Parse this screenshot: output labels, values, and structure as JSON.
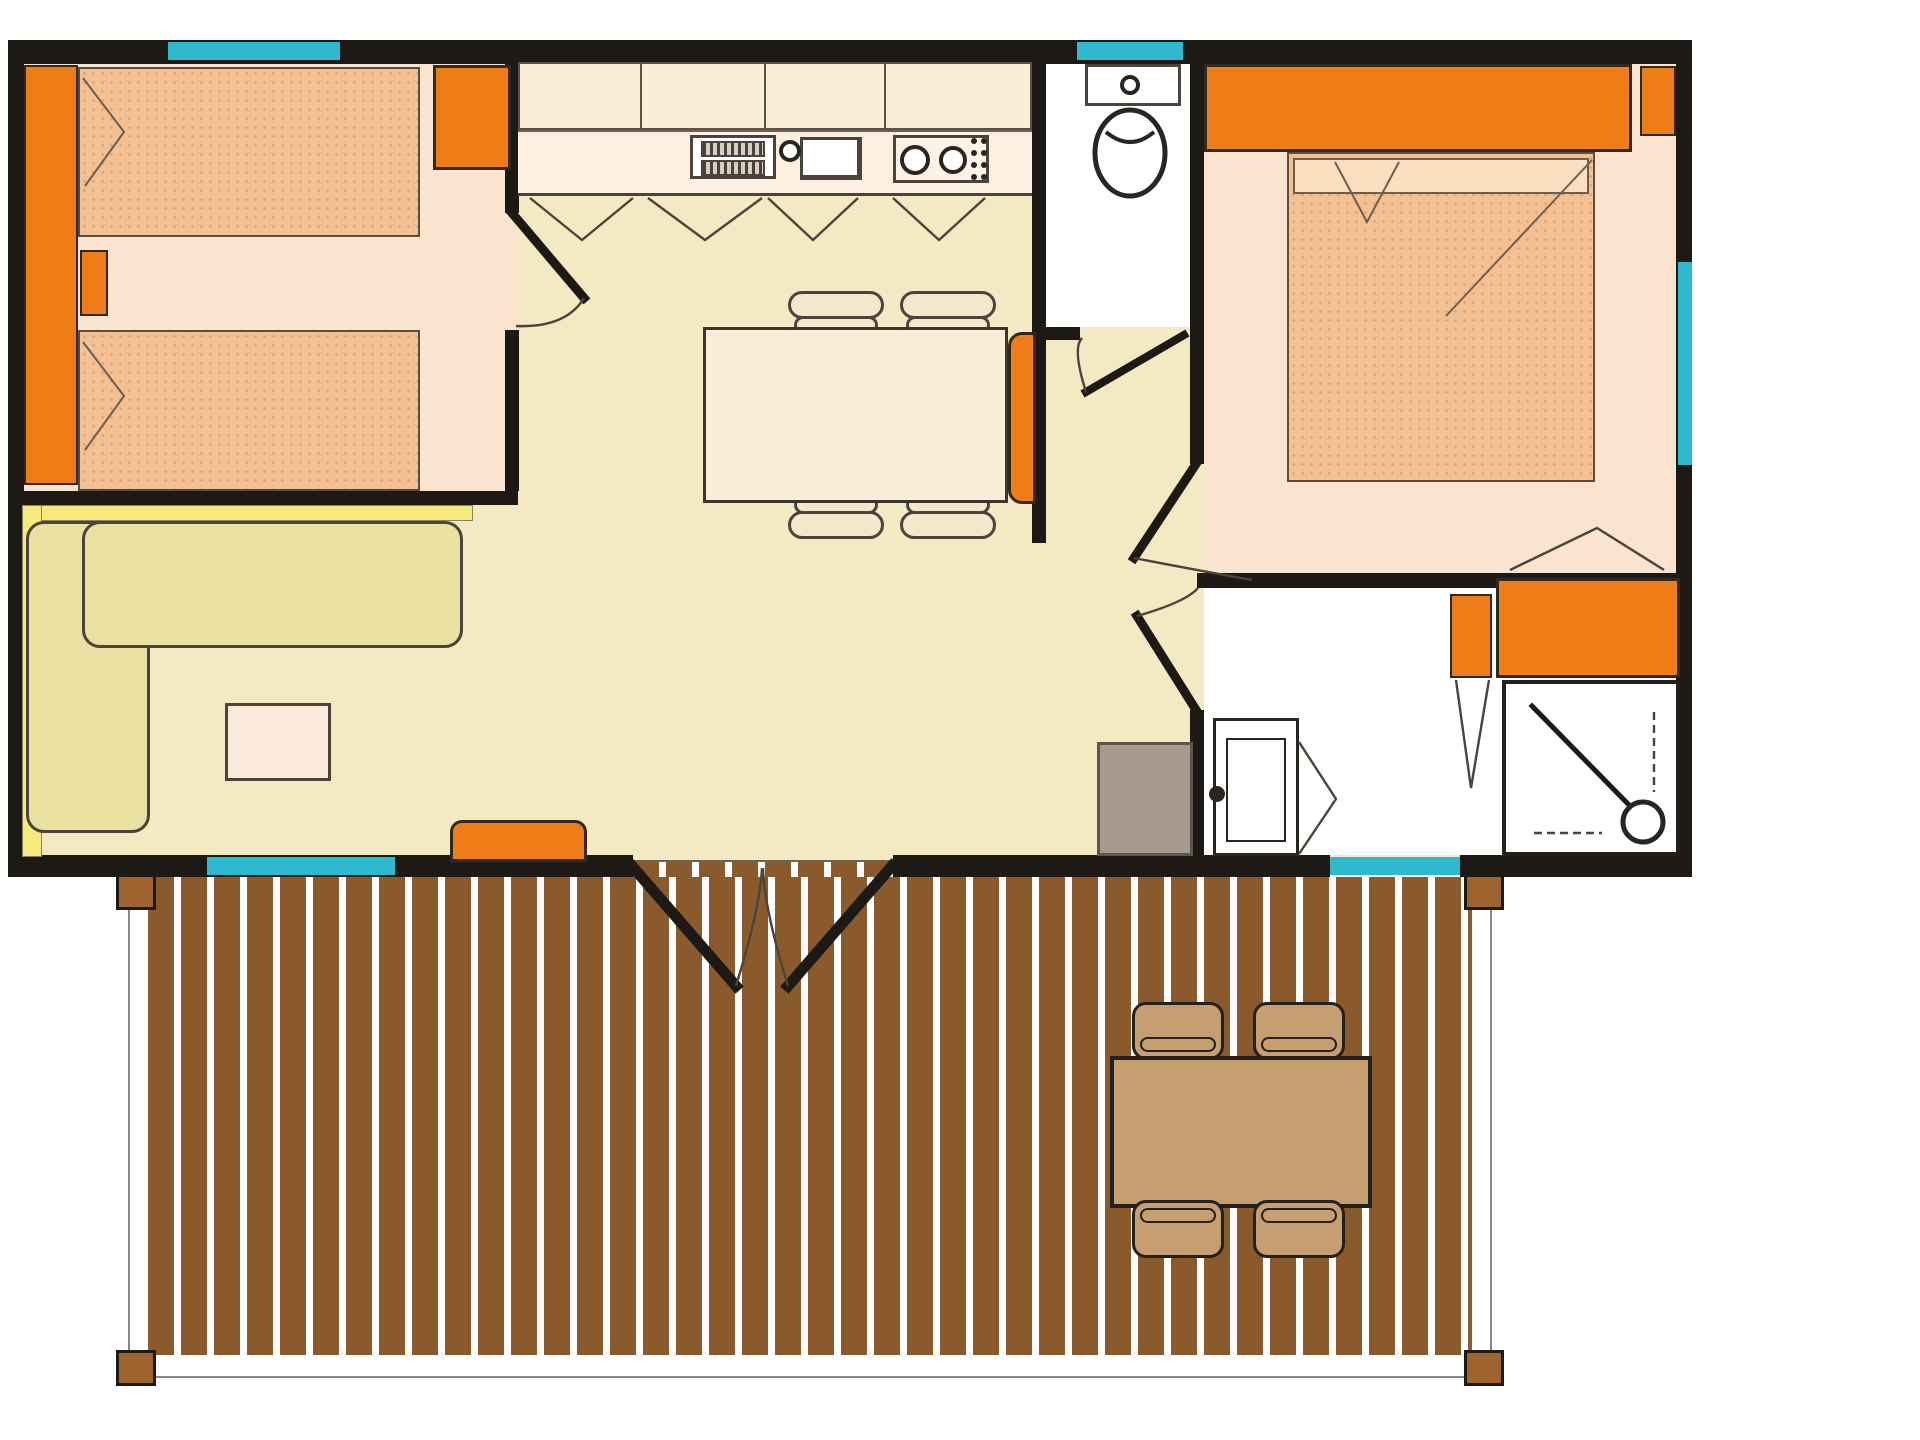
{
  "meta": {
    "type": "floor-plan",
    "description": "Holiday mobile-home floor plan, top view, with two bedrooms, kitchen/living open area, WC, shower room and a large front wooden deck with outdoor table"
  },
  "colors": {
    "wall": "#1d1914",
    "line": "#4a443c",
    "thin_line": "#6a6257",
    "window": "#2fb9cf",
    "floor_open": "#f3e9c3",
    "floor_bedroom": "#fae4d0",
    "floor_wet": "#ffffff",
    "orange": "#ee7d17",
    "orange_edge": "#30291f",
    "bed": "#f4c091",
    "bed_light": "#fbdfc0",
    "sofa": "#eae0a0",
    "shelf": "#f6e97e",
    "cabinet": "#faeed6",
    "counter": "#fdf0e0",
    "table": "#fbeed8",
    "chair": "#f3e7cc",
    "deck_plank": "#8a5a2c",
    "deck_post": "#9c632f",
    "outdoor_wood": "#c59e71",
    "heater": "#a59a8b",
    "background": "#ffffff"
  },
  "rooms": [
    {
      "id": "bedroom-twin",
      "windows": 1,
      "doors": 1
    },
    {
      "id": "kitchen-dining-living-open-area",
      "windows": 1,
      "doors": 1
    },
    {
      "id": "wc",
      "windows": 1,
      "doors": 1
    },
    {
      "id": "master-bedroom",
      "windows": 1,
      "doors": 1
    },
    {
      "id": "shower-room",
      "windows": 1,
      "doors": 1
    },
    {
      "id": "deck-terrace",
      "windows": 0,
      "doors": 0
    }
  ],
  "furniture": [
    "twin-bed",
    "twin-bed",
    "nightstand",
    "wardrobe",
    "kitchen-upper-cabinets",
    "kitchen-counter",
    "sink",
    "draining-board",
    "stove",
    "dining-table",
    "dining-chair",
    "dining-chair",
    "dining-chair",
    "dining-chair",
    "dining-bench",
    "corner-sofa",
    "wall-shelf",
    "coffee-table",
    "tv-unit",
    "wc-washbasin",
    "toilet",
    "double-bed",
    "headboard",
    "nightstand",
    "bathroom-cabinet",
    "bathroom-cabinet",
    "washbasin-unit",
    "shower",
    "water-heater",
    "outdoor-table",
    "outdoor-chair",
    "outdoor-chair",
    "outdoor-chair",
    "outdoor-chair",
    "deck-post",
    "deck-post",
    "deck-post",
    "deck-post"
  ]
}
